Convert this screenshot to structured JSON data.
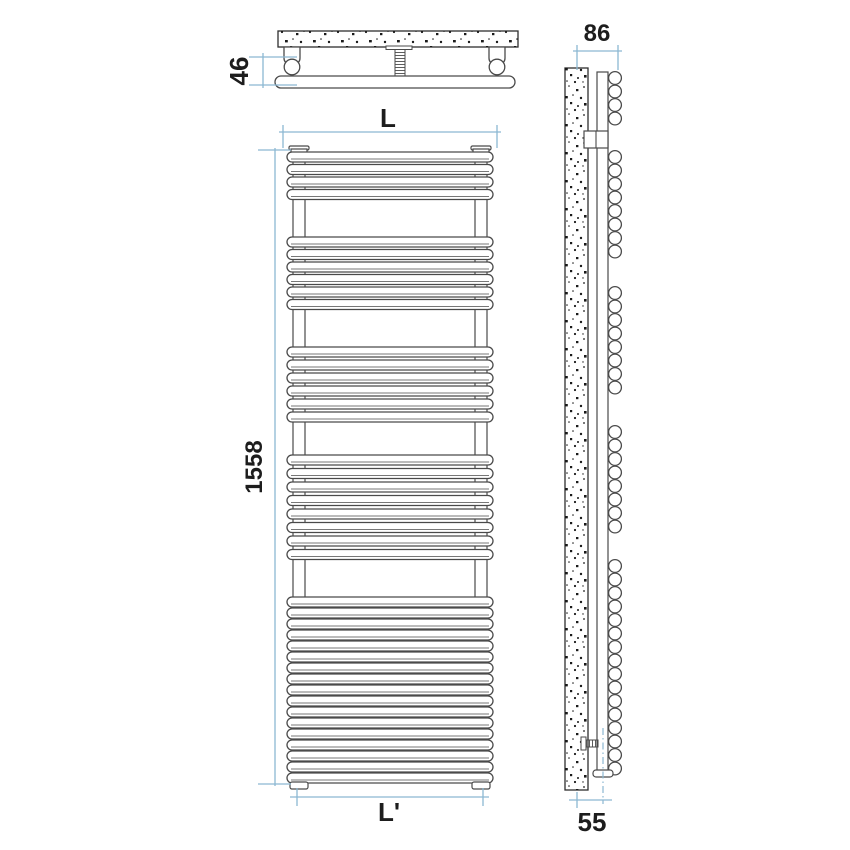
{
  "diagram": {
    "title": "towel-radiator-technical-drawing",
    "views": {
      "top_view_name": "top-view",
      "front_view_name": "front-view",
      "side_view_name": "side-view"
    },
    "dimensions": {
      "mount_depth": "46",
      "width_label": "L",
      "height": "1558",
      "bottom_width_label": "L'",
      "total_depth": "86",
      "wall_to_center": "55"
    },
    "front_view": {
      "bar_groups": [
        4,
        6,
        6,
        8,
        17
      ]
    },
    "side_view": {
      "circle_groups": [
        4,
        8,
        8,
        8,
        16
      ]
    },
    "colors": {
      "dimension_line": "#8cb8d2",
      "outline": "#4a4a4a",
      "wall_outline": "#2e2e2e",
      "text": "#1d1d1d",
      "background": "#ffffff"
    }
  }
}
